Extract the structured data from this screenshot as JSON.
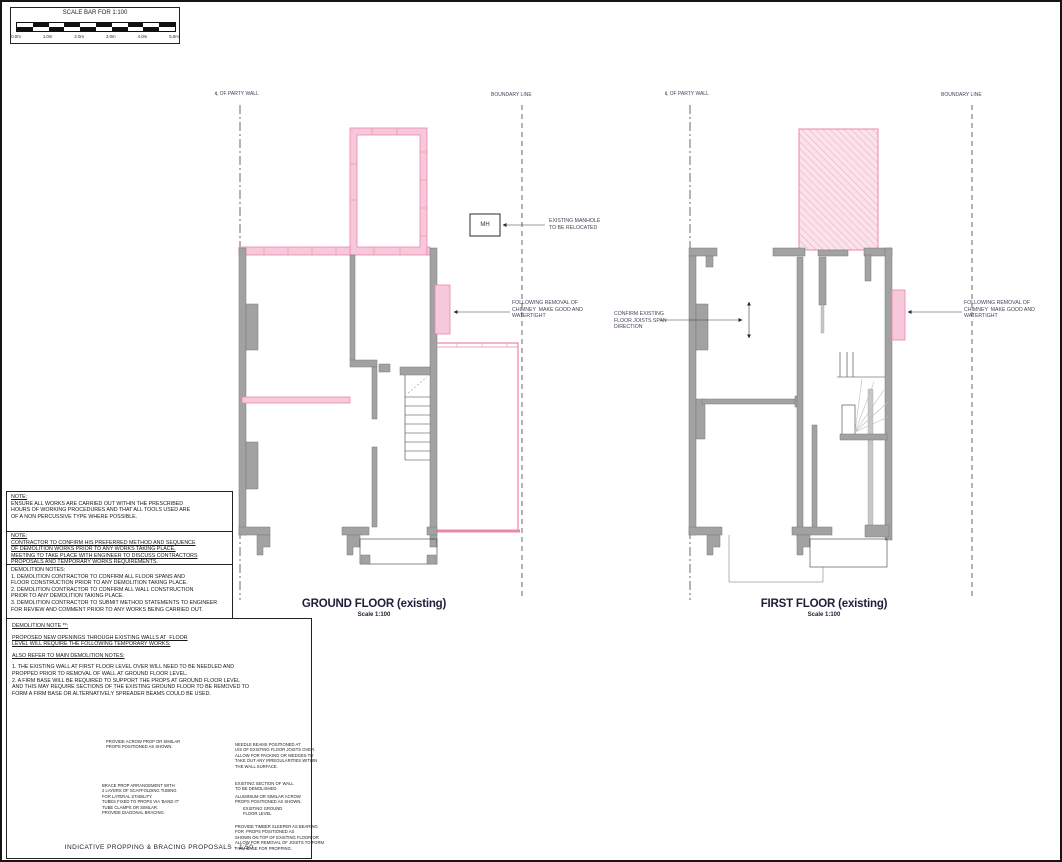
{
  "colors": {
    "demolition_pink": "#ee86ac",
    "pink_fill": "#f5c9da",
    "wall_grey": "#a2a2a2",
    "line": "#2a2a2a"
  },
  "scale_bar": {
    "title": "SCALE BAR FOR 1:100",
    "labels": [
      "0.0m",
      "1.0m",
      "2.0m",
      "3.0m",
      "4.0m",
      "5.0m"
    ]
  },
  "ground_floor": {
    "title": "GROUND FLOOR (existing)",
    "scale_label": "Scale 1:100",
    "party_wall_label": "℄ OF PARTY WALL",
    "boundary_label": "BOUNDARY LINE",
    "manhole_tag": "MH",
    "manhole_note": "EXISTING MANHOLE\nTO BE RELOCATED",
    "chimney_note": "FOLLOWING REMOVAL OF\nCHIMNEY  MAKE GOOD AND\nWATERTIGHT"
  },
  "first_floor": {
    "title": "FIRST FLOOR (existing)",
    "scale_label": "Scale 1:100",
    "party_wall_label": "℄ OF PARTY WALL",
    "boundary_label": "BOUNDARY LINE",
    "joist_note": "CONFIRM EXISTING\nFLOOR JOISTS SPAN\nDIRECTION",
    "chimney_note": "FOLLOWING REMOVAL OF\nCHIMNEY  MAKE GOOD AND\nWATERTIGHT"
  },
  "notes": {
    "note1_heading": "NOTE:",
    "note1_body": "ENSURE ALL WORKS ARE CARRIED OUT WITHIN THE PRESCRIBED\nHOURS OF WORKING PROCEDURES AND THAT ALL TOOLS USED ARE\nOF A NON PERCUSSIVE TYPE WHERE POSSIBLE.",
    "note2_heading": "NOTE:",
    "note2_body": "CONTRACTOR TO CONFIRM HIS PREFERRED METHOD AND SEQUENCE\nOF DEMOLITION WORKS PRIOR TO ANY WORKS TAKING PLACE.\nMEETING TO TAKE PLACE WITH ENGINEER TO DISCUSS CONTRACTORS\nPROPOSALS AND TEMPORARY WORKS REQUIREMENTS.",
    "demolition_heading": "DEMOLITION NOTES:",
    "demolition_body": "1. DEMOLITION CONTRACTOR TO CONFIRM ALL FLOOR SPANS AND\nFLOOR CONSTRUCTION PRIOR TO ANY DEMOLITION TAKING PLACE.\n2. DEMOLITION CONTRACTOR TO CONFIRM ALL WALL CONSTRUCTION\nPRIOR TO ANY DEMOLITION TAKING PLACE.\n3. DEMOLITION CONTRACTOR TO SUBMIT METHOD STATEMENTS TO ENGINEER\nFOR REVIEW AND COMMENT PRIOR TO ANY WORKS BEING CARRIED OUT."
  },
  "demolition_note_box": {
    "heading": "DEMOLITION NOTE **:",
    "para1": "PROPOSED NEW OPENINGS THROUGH EXISTING WALLS AT  FLOOR\nLEVEL WILL REQUIRE THE FOLLOWING TEMPORARY WORKS:",
    "para2": "ALSO REFER TO MAIN DEMOLITION NOTES:",
    "para3": "1. THE EXISTING WALL AT FIRST FLOOR LEVEL OVER WILL NEED TO BE NEEDLED AND\nPROPPED PRIOR TO REMOVAL OF WALL AT GROUND FLOOR LEVEL.\n2. A FIRM BASE WILL BE REQUIRED TO SUPPORT THE PROPS AT GROUND FLOOR LEVEL\nAND THIS MAY REQUIRE SECTIONS OF THE EXISTING GROUND FLOOR TO BE REMOVED TO\nFORM A FIRM BASE OR ALTERNATIVELY SPREADER BEAMS COULD BE USED."
  },
  "propping": {
    "caption": "INDICATIVE PROPPING & BRACING PROPOSALS - 1:50",
    "ann_props": "PROVIDE ACROW PROP OR SIMILAR\nPROPS POSITIONED AS SHOWN.",
    "ann_brace": "BRACE PROP ARRANGEMENT WITH\n2 LAYERS OF SCAFFOLDING TUBING\nFOR LATERAL STABILITY.\nTUBES FIXED TO PROPS VIA 'BAND IT'\nTUBE CLAMPS OR SIMILAR.\nPROVIDE DIAGONAL BRACING.",
    "ann_needle": "NEEDLE BEAMS POSITIONED AT\nU/S OF EXISTING FLOOR JOISTS OVER.\nALLOW FOR PACKING OR WEDGES TO\nTAKE OUT ANY IRREGULARITIES WITHIN\nTHE WALL SURFACE.",
    "ann_wall": "EXISTING SECTION OF WALL\nTO BE DEMOLISHED.",
    "ann_acrow": "ALUMINIUM OR SIMILAR ACROW\nPROPS POSITIONED AS SHOWN.",
    "ann_ground": "EXISTING GROUND\nFLOOR LEVEL",
    "ann_sleeper": "PROVIDE TIMBER SLEEPER AS BEARING\nFOR  PROPS POSITIONED AS\nSHOWN ON TOP OF EXISTING FLOOR OR\nALLOW FOR REMOVAL OF JOISTS TO FORM\nFIRM BASE FOR PROPPING."
  }
}
